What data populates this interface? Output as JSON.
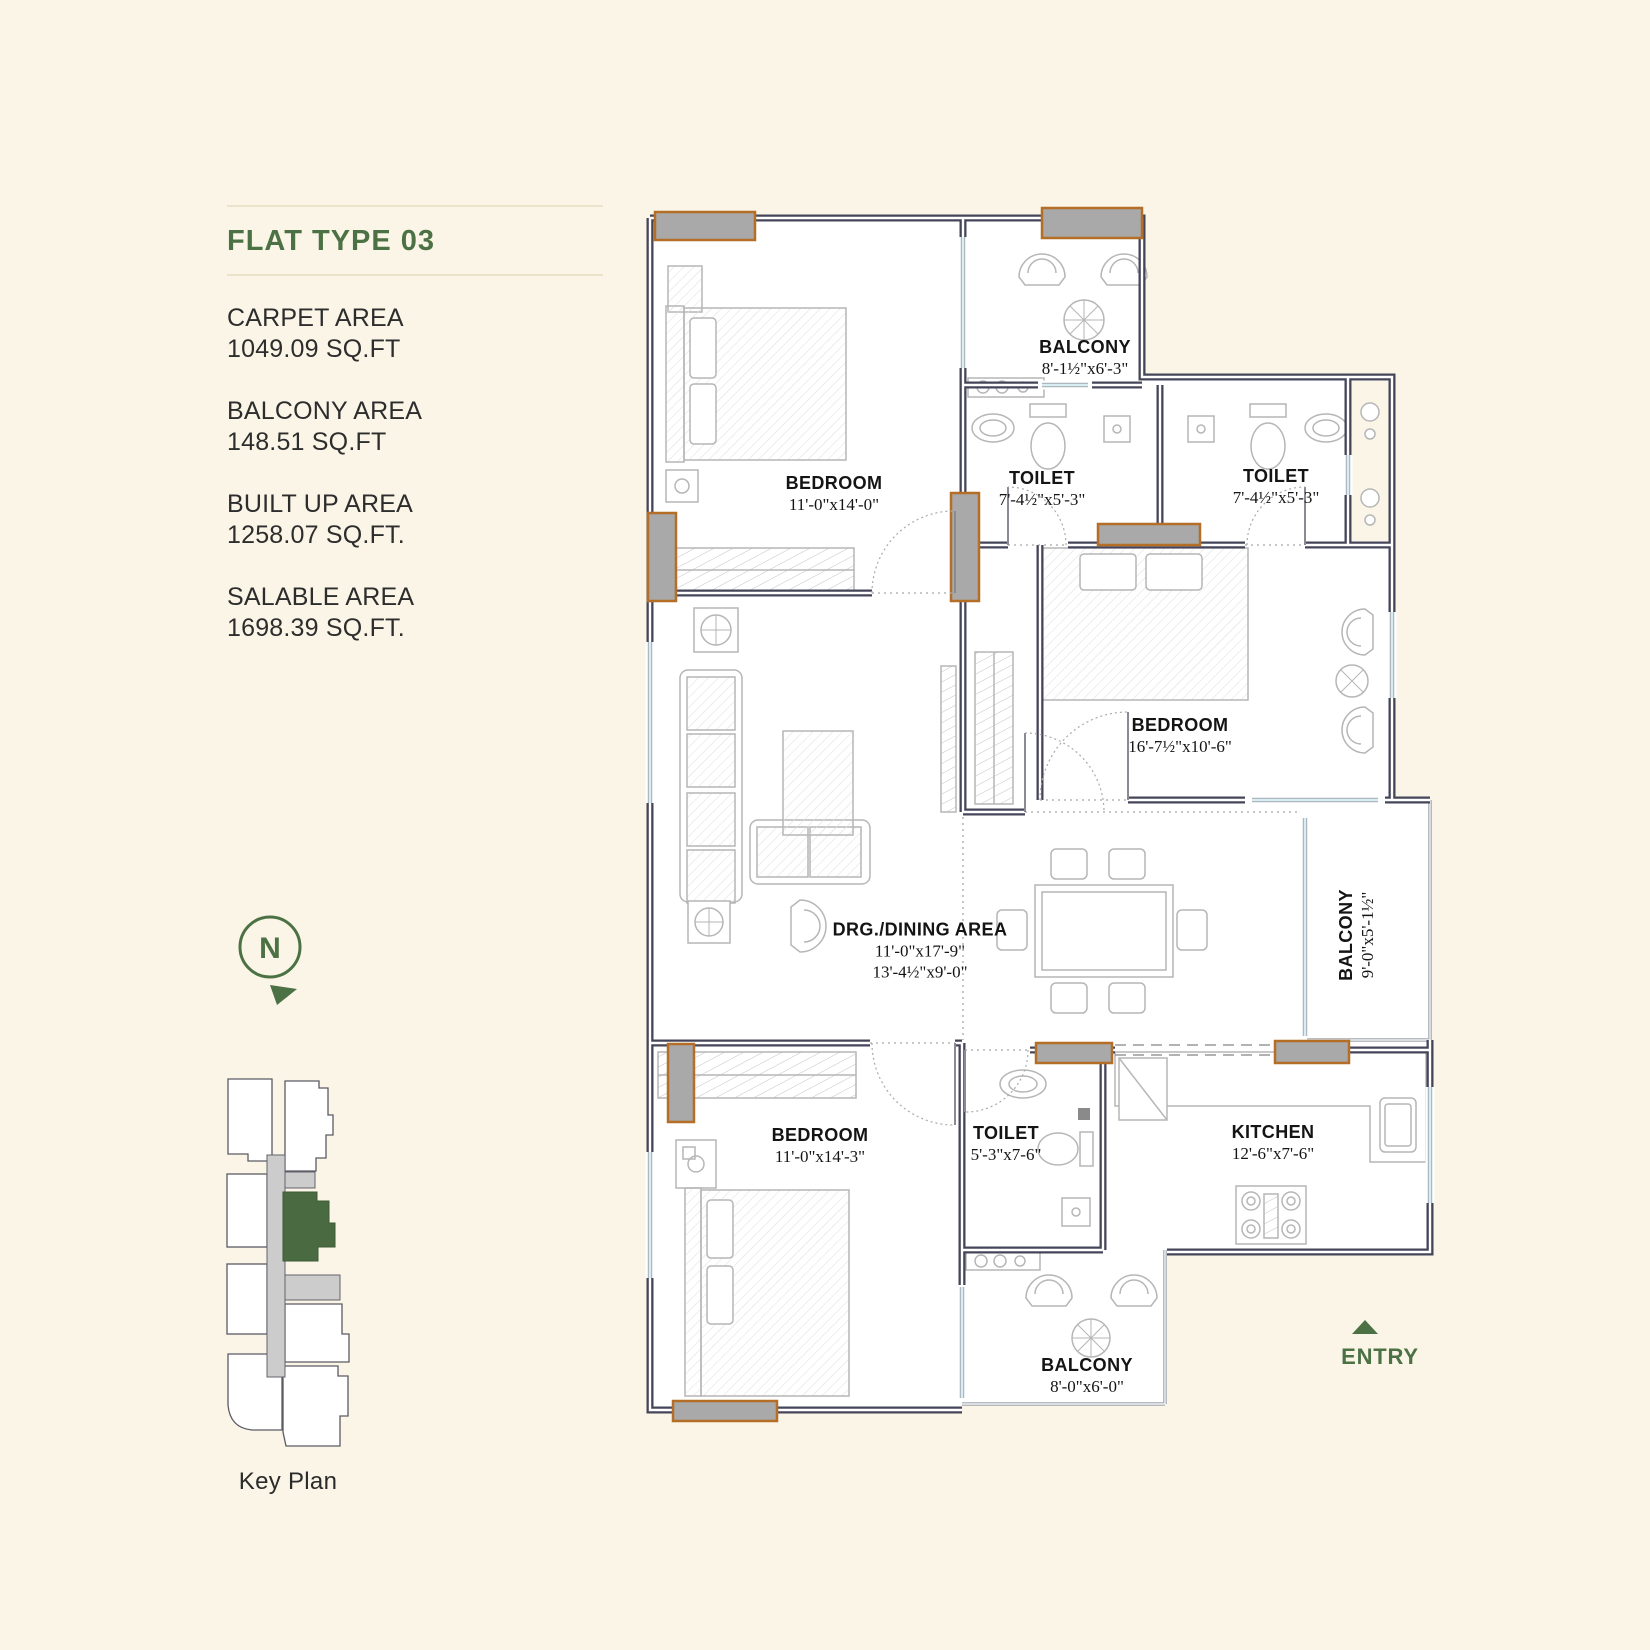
{
  "panel": {
    "title": "FLAT TYPE 03",
    "areas": [
      {
        "label": "CARPET AREA",
        "value": "1049.09 SQ.FT"
      },
      {
        "label": "BALCONY AREA",
        "value": "148.51 SQ.FT"
      },
      {
        "label": "BUILT UP AREA",
        "value": "1258.07 SQ.FT."
      },
      {
        "label": "SALABLE AREA",
        "value": "1698.39 SQ.FT."
      }
    ],
    "compass": {
      "letter": "N"
    },
    "key_plan_caption": "Key Plan"
  },
  "plan": {
    "rooms": [
      {
        "id": "bedroom-top-left",
        "name": "BEDROOM",
        "dims": "11'-0\"x14'-0\""
      },
      {
        "id": "balcony-top",
        "name": "BALCONY",
        "dims": "8'-1½\"x6'-3\""
      },
      {
        "id": "toilet-1",
        "name": "TOILET",
        "dims": "7'-4½\"x5'-3\""
      },
      {
        "id": "toilet-2",
        "name": "TOILET",
        "dims": "7'-4½\"x5'-3\""
      },
      {
        "id": "bedroom-right",
        "name": "BEDROOM",
        "dims": "16'-7½\"x10'-6\""
      },
      {
        "id": "balcony-right",
        "name": "BALCONY",
        "dims": "9'-0\"x5'-1½\""
      },
      {
        "id": "drg-dining",
        "name": "DRG./DINING AREA",
        "dims": "11'-0\"x17'-9\"",
        "dims2": "13'-4½\"x9'-0\""
      },
      {
        "id": "bedroom-bottom",
        "name": "BEDROOM",
        "dims": "11'-0\"x14'-3\""
      },
      {
        "id": "toilet-3",
        "name": "TOILET",
        "dims": "5'-3\"x7-6\""
      },
      {
        "id": "kitchen",
        "name": "KITCHEN",
        "dims": "12'-6\"x7'-6\""
      },
      {
        "id": "balcony-bottom",
        "name": "BALCONY",
        "dims": "8'-0\"x6'-0\""
      }
    ],
    "entry_label": "ENTRY"
  },
  "colors": {
    "background": "#FAF5E6",
    "accent_green": "#4C7144",
    "wall": "#45455A",
    "column_gray": "#A9A9A9",
    "column_orange": "#B46E28",
    "glazing": "#C9DFE6"
  }
}
